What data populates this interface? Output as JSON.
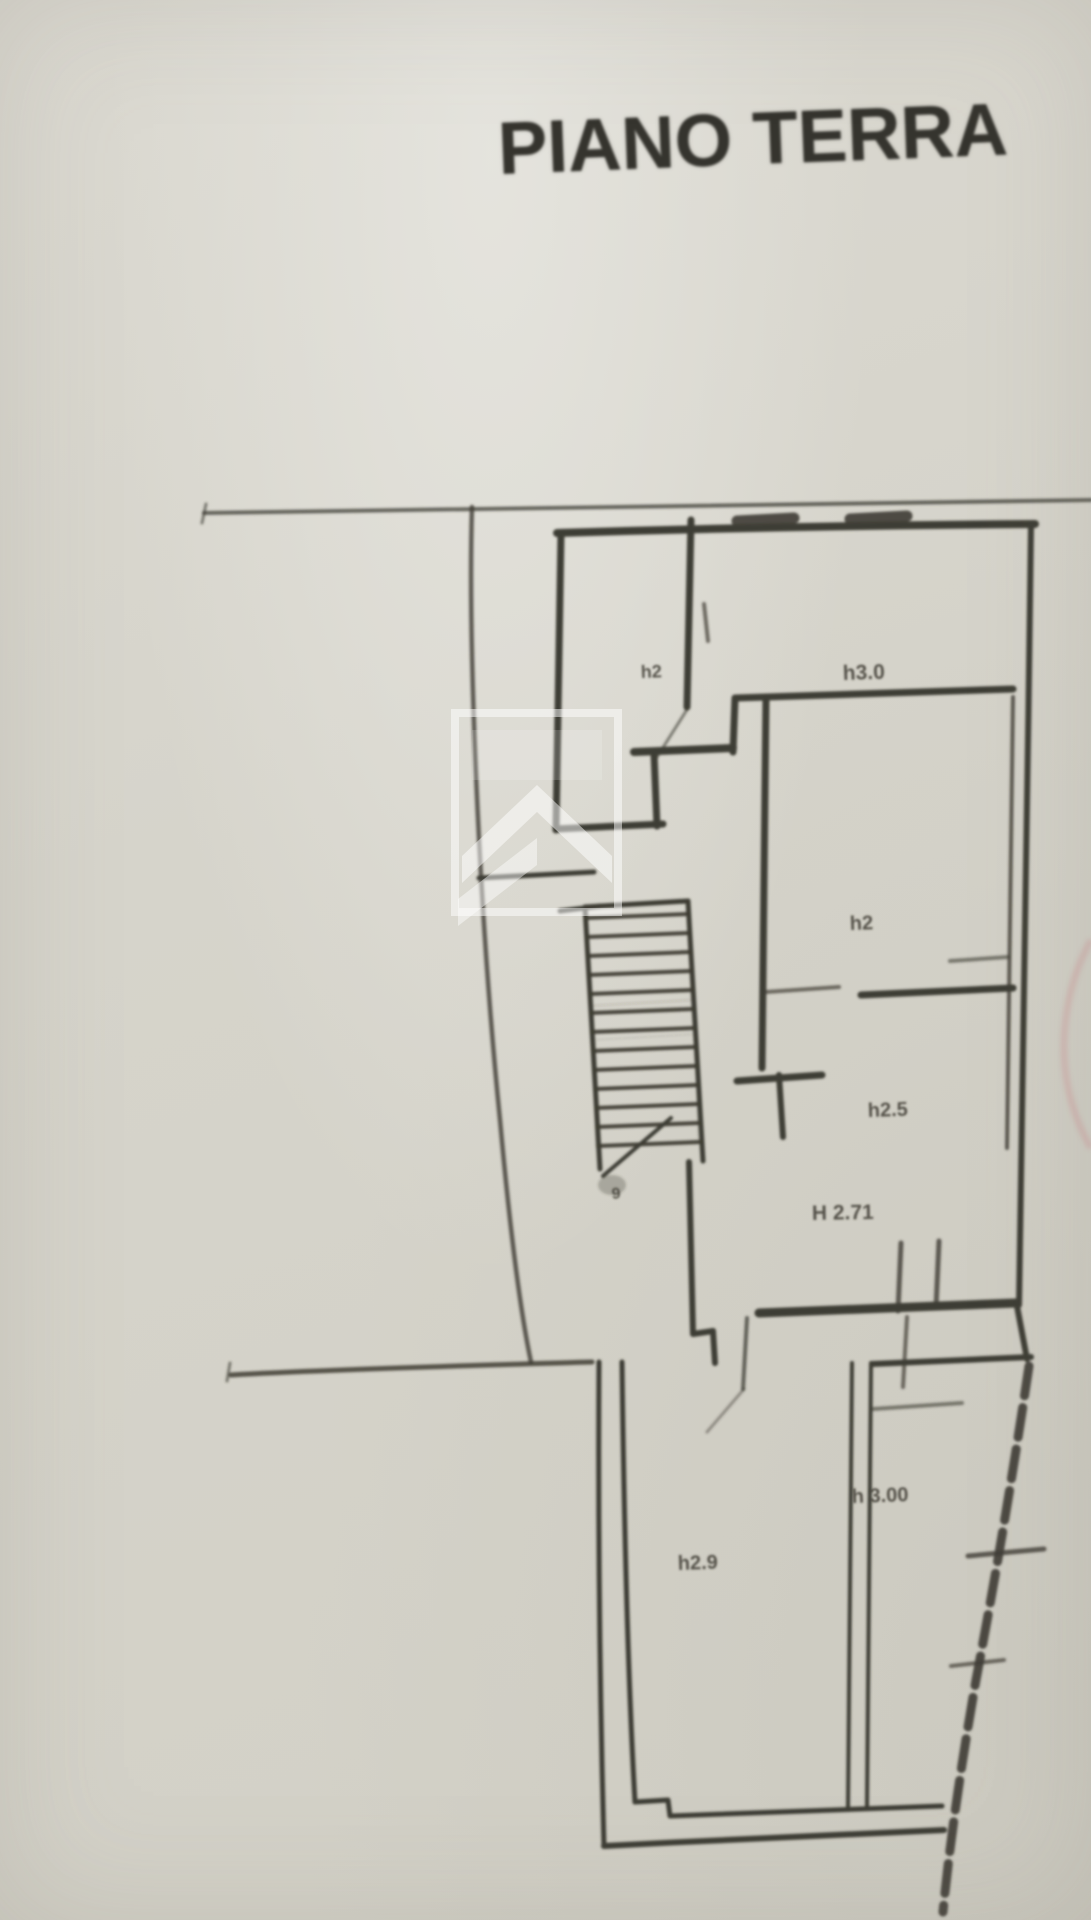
{
  "title": {
    "text": "PIANO TERRA"
  },
  "plan": {
    "floor_name": "PIANO TERRA",
    "labels": [
      {
        "id": "room-height-label-1",
        "text": "h2",
        "x": 641,
        "y": 678,
        "size": 18,
        "rotate": -2
      },
      {
        "id": "room-height-label-2",
        "text": "h3.0",
        "x": 843,
        "y": 680,
        "size": 21,
        "rotate": -2
      },
      {
        "id": "room-height-label-3",
        "text": "h2",
        "x": 850,
        "y": 930,
        "size": 20,
        "rotate": -2
      },
      {
        "id": "room-height-label-4",
        "text": "h2.5",
        "x": 868,
        "y": 1117,
        "size": 20,
        "rotate": -2
      },
      {
        "id": "room-height-label-5",
        "text": "H 2.71",
        "x": 812,
        "y": 1220,
        "size": 21,
        "rotate": -1
      },
      {
        "id": "room-height-label-6",
        "text": "h 3.00",
        "x": 852,
        "y": 1503,
        "size": 20,
        "rotate": -2
      },
      {
        "id": "room-height-label-7",
        "text": "h2.9",
        "x": 678,
        "y": 1570,
        "size": 20,
        "rotate": -2
      },
      {
        "id": "stair-mark-label",
        "text": "9",
        "x": 612,
        "y": 1199,
        "size": 16,
        "rotate": -4
      }
    ],
    "watermark": {
      "description": "real-estate agency chevron logo watermark"
    },
    "colors": {
      "paper": "#d6d4cb",
      "ink": "#3e3c34",
      "title_ink": "#35342e",
      "watermark": "#ffffff",
      "pen_mark_pink": "#cf9e9e"
    }
  }
}
